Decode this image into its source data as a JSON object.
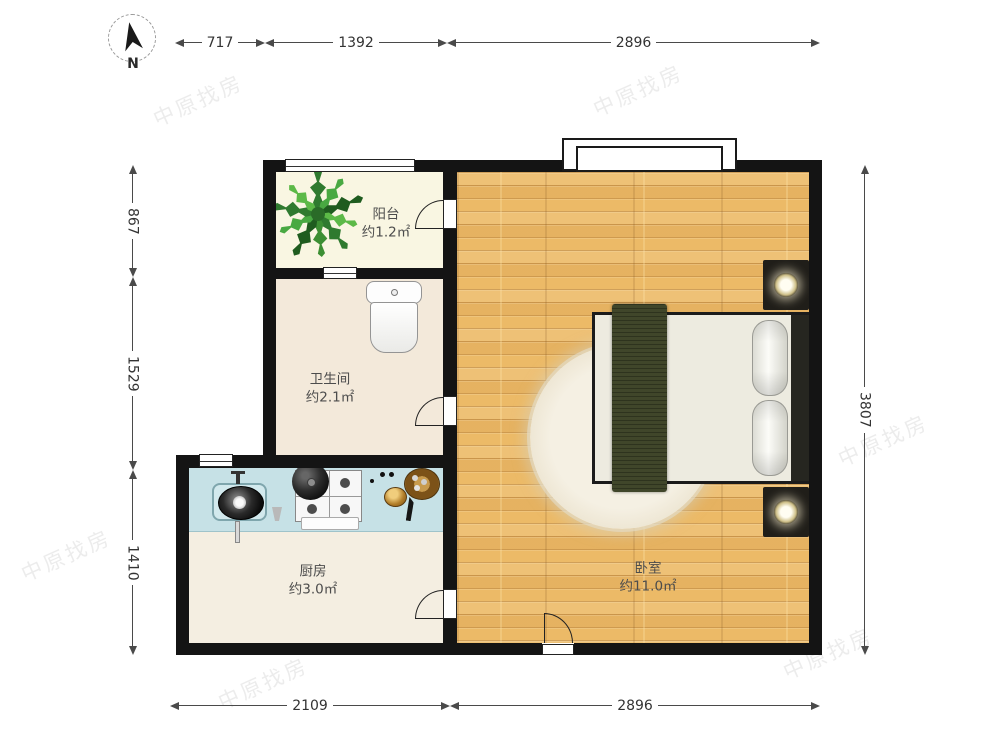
{
  "compass": {
    "label": "N"
  },
  "dimensions": {
    "top": [
      {
        "value": "717"
      },
      {
        "value": "1392"
      },
      {
        "value": "2896"
      }
    ],
    "left": [
      {
        "value": "867"
      },
      {
        "value": "1529"
      },
      {
        "value": "1410"
      }
    ],
    "right": [
      {
        "value": "3807"
      }
    ],
    "bottom": [
      {
        "value": "2109"
      },
      {
        "value": "2896"
      }
    ]
  },
  "rooms": [
    {
      "name": "阳台",
      "area": "约1.2㎡"
    },
    {
      "name": "卫生间",
      "area": "约2.1㎡"
    },
    {
      "name": "厨房",
      "area": "约3.0㎡"
    },
    {
      "name": "卧室",
      "area": "约11.0㎡"
    }
  ],
  "watermark": {
    "text": "中原找房"
  },
  "icons": [
    "north-arrow-icon",
    "plant-icon",
    "sink-icon",
    "stove-icon",
    "washing-machine-icon",
    "bed-icon",
    "lamp-icon",
    "door-arc-icon"
  ],
  "colors": {
    "wall": "#141414",
    "wood_floor": "#ecba67",
    "balcony_floor": "#f9f6e2",
    "bath_floor": "#f3e9da",
    "kitchen_floor": "#f4eee1",
    "counter": "#c6e1e6",
    "blanket": "#40462a",
    "dimension_line": "#4a4a4a"
  }
}
